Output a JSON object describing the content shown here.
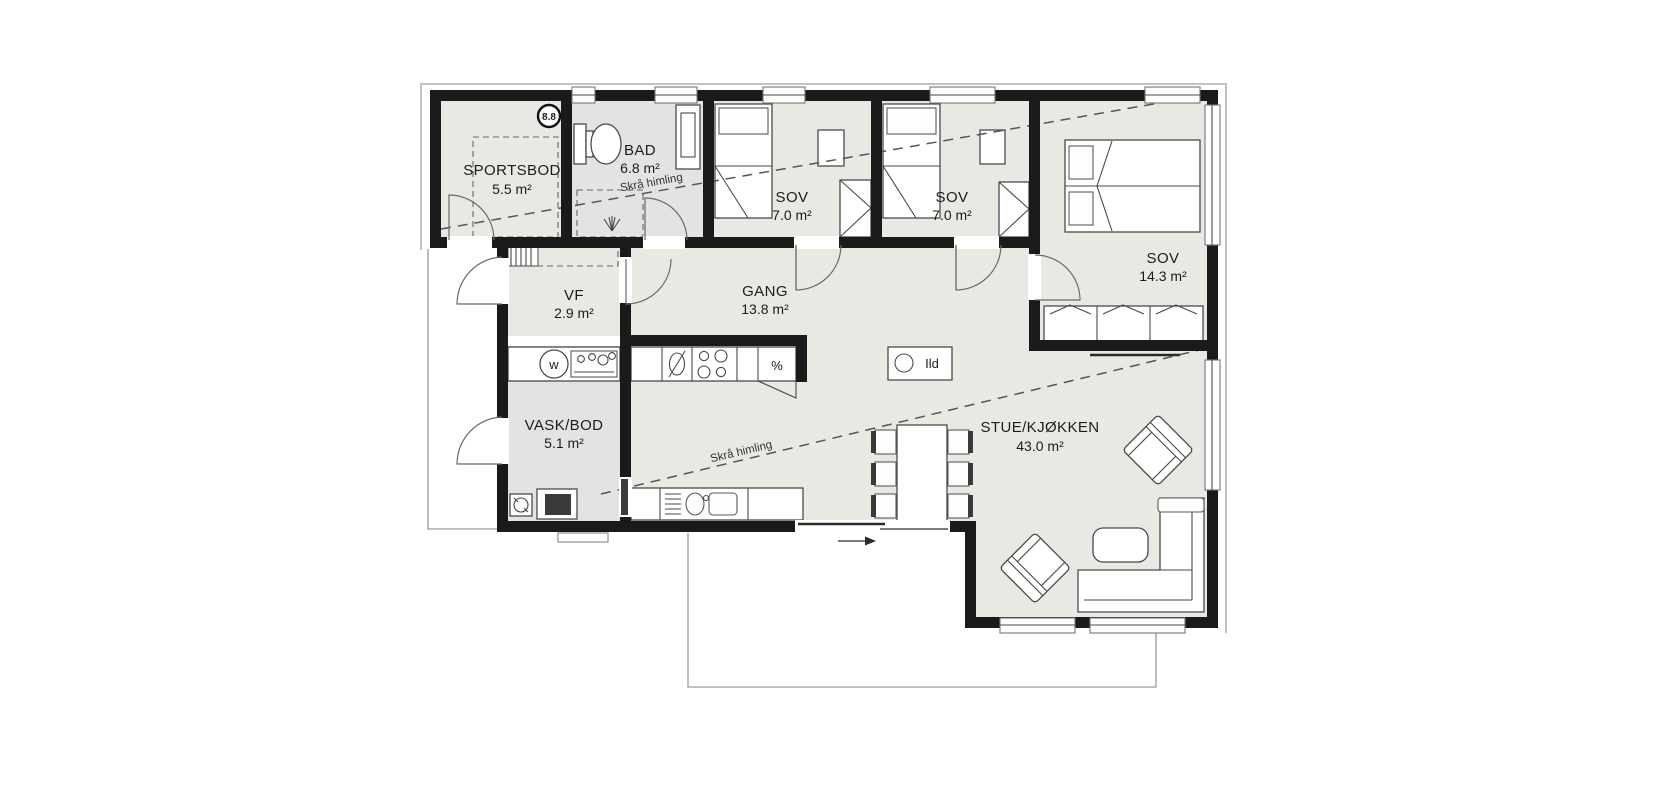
{
  "plan": {
    "marker_label": "8.8",
    "rooms": {
      "sportsbod": {
        "name": "SPORTSBOD",
        "area": "5.5 m²"
      },
      "bad": {
        "name": "BAD",
        "area": "6.8 m²"
      },
      "sov1": {
        "name": "SOV",
        "area": "7.0 m²"
      },
      "sov2": {
        "name": "SOV",
        "area": "7.0 m²"
      },
      "sov3": {
        "name": "SOV",
        "area": "14.3 m²"
      },
      "vf": {
        "name": "VF",
        "area": "2.9 m²"
      },
      "gang": {
        "name": "GANG",
        "area": "13.8 m²"
      },
      "vask": {
        "name": "VASK/BOD",
        "area": "5.1 m²"
      },
      "stue": {
        "name": "STUE/KJØKKEN",
        "area": "43.0 m²"
      }
    },
    "annotations": {
      "sloped_ceiling": "Skrå himling",
      "fireplace": "Ild",
      "washer_symbol": "w",
      "oven_symbol": "%"
    },
    "colors": {
      "wall": "#1a1a1a",
      "floor": "#eae8e2",
      "wet_room_floor": "#e3e3e4",
      "line": "#555555"
    }
  }
}
